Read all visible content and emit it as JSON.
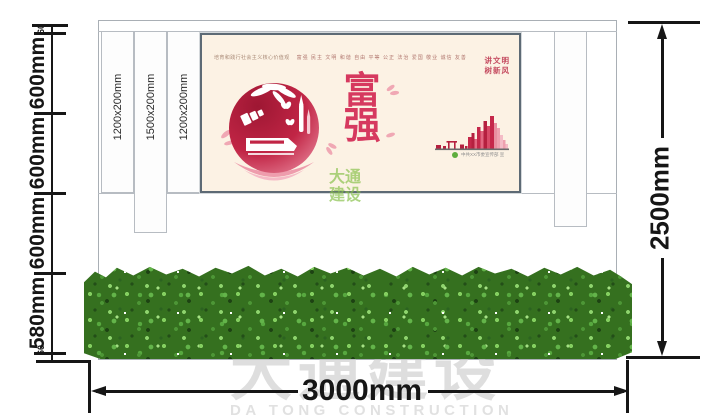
{
  "dimensions": {
    "left_segments": [
      "60",
      "600mm",
      "600mm",
      "600mm",
      "580mm",
      "60"
    ],
    "right_label": "2500mm",
    "bottom_label": "3000mm",
    "panel_labels": [
      "1200x200mm",
      "1500x200mm",
      "1200x200mm"
    ]
  },
  "poster": {
    "tagline": "培育和践行社会主义核心价值观",
    "core_values": "富强 民主 文明 和谐 自由 平等 公正 法治 爱国 敬业 诚信 友善",
    "headline": [
      "富",
      "强"
    ],
    "slogan_lines": [
      "讲文明",
      "树新风"
    ],
    "credit": "中共XX市委宣传部 宣"
  },
  "watermark": {
    "logo_cn_line1": "大通",
    "logo_cn_line2": "建设",
    "brand_cn": "大通建设",
    "brand_en": "DA TONG CONSTRUCTION"
  },
  "colors": {
    "dimension_ink": "#161616",
    "poster_bg": "#fcf2e4",
    "headline_red": "#d6395f",
    "crimson_dark": "#b5203f",
    "pink_light": "#eea1af",
    "hedge_green": "#3f8a2e",
    "watermark_gray": "#c9c9c9",
    "logo_green": "#86c048"
  }
}
